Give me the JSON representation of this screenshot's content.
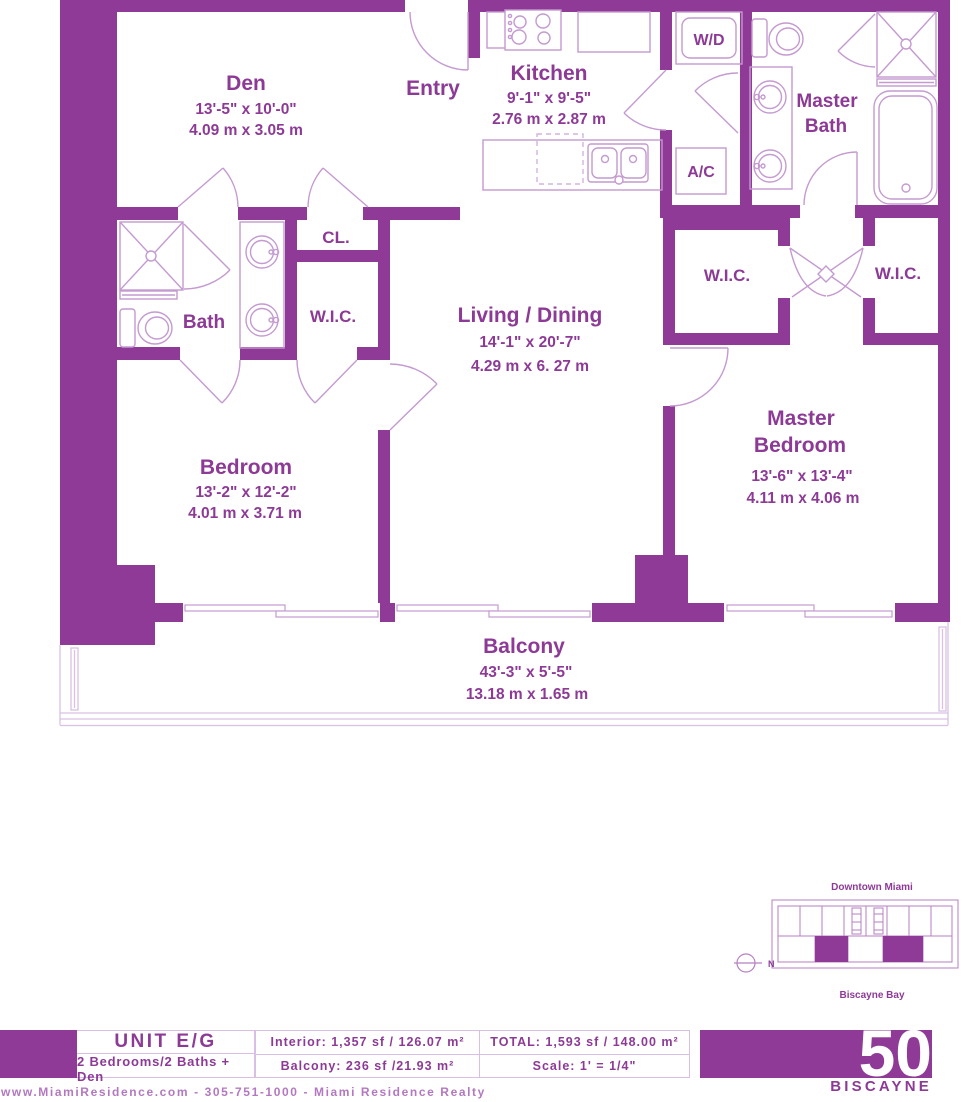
{
  "colors": {
    "wall_purple": "#8e3a96",
    "label_purple": "#8d3a96",
    "line_light": "#c49ad0",
    "railing_light": "#d9c0e4",
    "footer_light": "#b379c0",
    "white": "#ffffff"
  },
  "rooms": {
    "den": {
      "name": "Den",
      "ft": "13'-5\" x 10'-0\"",
      "m": "4.09 m x 3.05 m"
    },
    "entry": {
      "name": "Entry"
    },
    "kitchen": {
      "name": "Kitchen",
      "ft": "9'-1\" x 9'-5\"",
      "m": "2.76 m x 2.87 m"
    },
    "master_bath": {
      "line1": "Master",
      "line2": "Bath"
    },
    "wd": {
      "name": "W/D"
    },
    "ac": {
      "name": "A/C"
    },
    "cl": {
      "name": "CL."
    },
    "wic_left": {
      "name": "W.I.C."
    },
    "bath": {
      "name": "Bath"
    },
    "living": {
      "name": "Living / Dining",
      "ft": "14'-1\" x 20'-7\"",
      "m": "4.29 m x 6. 27 m"
    },
    "wic_center": {
      "name": "W.I.C."
    },
    "wic_right": {
      "name": "W.I.C."
    },
    "bedroom": {
      "name": "Bedroom",
      "ft": "13'-2\" x 12'-2\"",
      "m": "4.01 m x 3.71 m"
    },
    "master_bedroom": {
      "line1": "Master",
      "line2": "Bedroom",
      "ft": "13'-6\" x 13'-4\"",
      "m": "4.11 m x 4.06 m"
    },
    "balcony": {
      "name": "Balcony",
      "ft": "43'-3\" x 5'-5\"",
      "m": "13.18 m x 1.65 m"
    }
  },
  "keyplan": {
    "top_label": "Downtown Miami",
    "bottom_label": "Biscayne Bay",
    "compass": "N"
  },
  "infobar": {
    "unit": "UNIT E/G",
    "config": "2 Bedrooms/2 Baths + Den",
    "interior": "Interior: 1,357 sf / 126.07 m²",
    "balcony": "Balcony: 236 sf /21.93 m²",
    "total": "TOTAL: 1,593 sf / 148.00 m²",
    "scale": "Scale: 1' = 1/4\""
  },
  "logo": {
    "number": "50",
    "name": "BISCAYNE"
  },
  "footer": {
    "website": "www.MiamiResidence.com - 305-751-1000 - Miami Residence Realty"
  }
}
